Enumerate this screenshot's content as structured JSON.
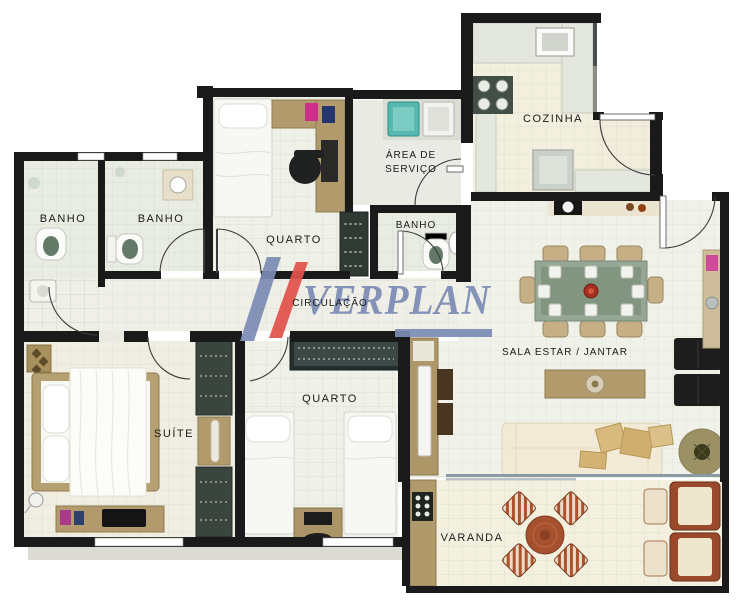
{
  "watermark": {
    "text": "VERPLAN",
    "blue": "#7c8cb5",
    "red": "#e2524c"
  },
  "rooms": {
    "banho1": {
      "label": "BANHO"
    },
    "banho2": {
      "label": "BANHO"
    },
    "quarto1": {
      "label": "QUARTO"
    },
    "area_servico": {
      "line1": "ÁREA DE",
      "line2": "SERVIÇO"
    },
    "banho3": {
      "label": "BANHO"
    },
    "cozinha": {
      "label": "COZINHA"
    },
    "circulacao": {
      "label": "CIRCULAÇÃO"
    },
    "sala": {
      "label": "SALA ESTAR / JANTAR"
    },
    "suite": {
      "label": "SUÍTE"
    },
    "quarto2": {
      "label": "QUARTO"
    },
    "varanda": {
      "label": "VARANDA"
    }
  },
  "colors": {
    "wall": "#1a1a1a",
    "floor_sala": "#f0f2ea",
    "floor_warm": "#f3efdf",
    "floor_bath": "#e8ece3",
    "wood": "#b19b6d",
    "wardrobe_dark": "#39453e",
    "sofa_cream": "#f2ead7",
    "pillow_tan": "#d8b97e",
    "glass_table": "#95a694",
    "black_furniture": "#1d1d1d",
    "accent_red": "#a33020",
    "varanda_chair": "#a8502f",
    "teal_tank": "#57b8b0",
    "watermark_blue": "#7c8cb5",
    "watermark_red": "#e2524c"
  }
}
